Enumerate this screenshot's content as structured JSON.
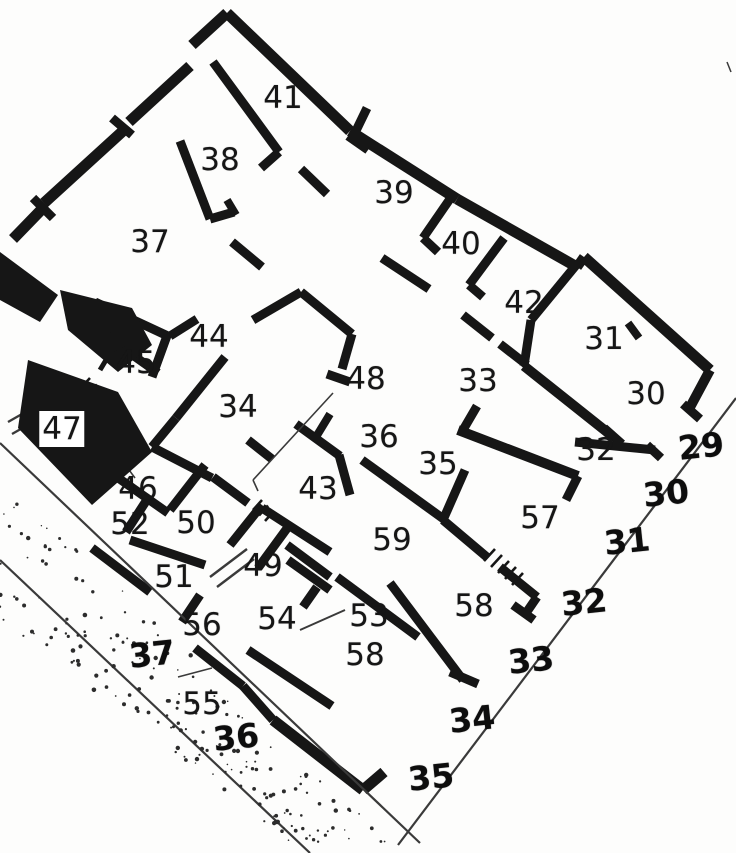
{
  "title": "Insula floor plan with numbered rooms and street entrances",
  "colors": {
    "ink": "#161616",
    "paper": "#fdfdfc",
    "thin_line": "#3a3a3a",
    "stipple": "#2c2c2c"
  },
  "rooms": [
    {
      "label": "41",
      "x": 283,
      "y": 98
    },
    {
      "label": "38",
      "x": 220,
      "y": 160
    },
    {
      "label": "39",
      "x": 394,
      "y": 193
    },
    {
      "label": "37",
      "x": 150,
      "y": 242
    },
    {
      "label": "40",
      "x": 461,
      "y": 244
    },
    {
      "label": "42",
      "x": 524,
      "y": 303
    },
    {
      "label": "31",
      "x": 604,
      "y": 339
    },
    {
      "label": "30",
      "x": 646,
      "y": 394
    },
    {
      "label": "44",
      "x": 209,
      "y": 337
    },
    {
      "label": "45",
      "x": 136,
      "y": 363
    },
    {
      "label": "48",
      "x": 366,
      "y": 379
    },
    {
      "label": "33",
      "x": 478,
      "y": 381
    },
    {
      "label": "34",
      "x": 238,
      "y": 407
    },
    {
      "label": "47",
      "x": 62,
      "y": 429,
      "backed": true
    },
    {
      "label": "36",
      "x": 379,
      "y": 437
    },
    {
      "label": "35",
      "x": 438,
      "y": 464
    },
    {
      "label": "32",
      "x": 596,
      "y": 450
    },
    {
      "label": "46",
      "x": 138,
      "y": 489
    },
    {
      "label": "43",
      "x": 318,
      "y": 489
    },
    {
      "label": "52",
      "x": 130,
      "y": 524
    },
    {
      "label": "50",
      "x": 196,
      "y": 523
    },
    {
      "label": "57",
      "x": 540,
      "y": 518
    },
    {
      "label": "59",
      "x": 392,
      "y": 540
    },
    {
      "label": "51",
      "x": 174,
      "y": 577
    },
    {
      "label": "49",
      "x": 263,
      "y": 566
    },
    {
      "label": "58",
      "x": 474,
      "y": 606
    },
    {
      "label": "56",
      "x": 202,
      "y": 625
    },
    {
      "label": "54",
      "x": 277,
      "y": 619
    },
    {
      "label": "53",
      "x": 369,
      "y": 616
    },
    {
      "label": "58",
      "x": 365,
      "y": 655
    },
    {
      "label": "55",
      "x": 202,
      "y": 704
    }
  ],
  "entrances": [
    {
      "label": "29",
      "x": 701,
      "y": 446
    },
    {
      "label": "30",
      "x": 666,
      "y": 493
    },
    {
      "label": "31",
      "x": 627,
      "y": 541
    },
    {
      "label": "32",
      "x": 584,
      "y": 602
    },
    {
      "label": "33",
      "x": 531,
      "y": 660
    },
    {
      "label": "34",
      "x": 472,
      "y": 719
    },
    {
      "label": "35",
      "x": 431,
      "y": 777
    },
    {
      "label": "36",
      "x": 236,
      "y": 737
    },
    {
      "label": "37",
      "x": 152,
      "y": 654
    }
  ]
}
